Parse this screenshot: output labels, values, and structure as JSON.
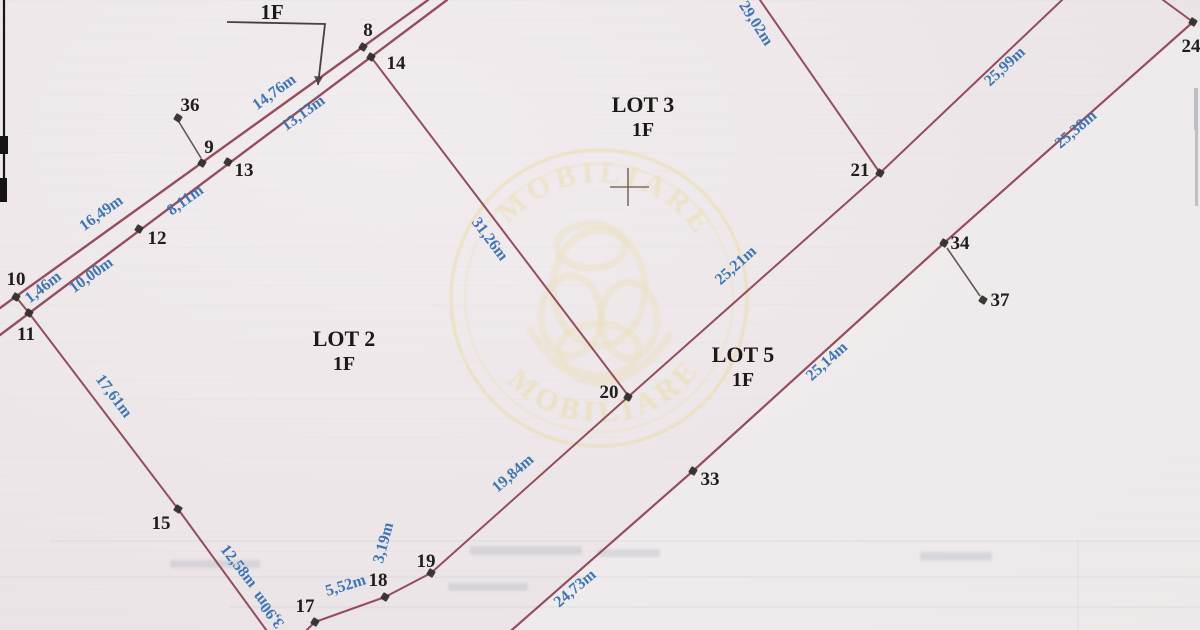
{
  "document": {
    "kind": "scanned cadastral lot plan",
    "floor_note": {
      "label": "1F",
      "x": 272,
      "y": 19,
      "bracket": [
        [
          227,
          22
        ],
        [
          325,
          24
        ],
        [
          318,
          85
        ]
      ]
    },
    "lot_labels": [
      {
        "name": "LOT 3",
        "floor": "1F",
        "x": 643,
        "y": 112
      },
      {
        "name": "LOT 2",
        "floor": "1F",
        "x": 344,
        "y": 346
      },
      {
        "name": "LOT 5",
        "floor": "1F",
        "x": 743,
        "y": 362
      }
    ],
    "cross_marker": {
      "x": 628,
      "y": 187
    },
    "boundary_lines": [
      {
        "x1": 0,
        "y1": 308,
        "x2": 428,
        "y2": 0,
        "w": 2.4
      },
      {
        "x1": 0,
        "y1": 335,
        "x2": 447,
        "y2": 0,
        "w": 2.4
      },
      {
        "x1": 16,
        "y1": 297,
        "x2": 29,
        "y2": 313,
        "w": 2
      },
      {
        "x1": 371,
        "y1": 57,
        "x2": 630,
        "y2": 398,
        "w": 2
      },
      {
        "x1": 29,
        "y1": 313,
        "x2": 178,
        "y2": 509,
        "w": 2
      },
      {
        "x1": 178,
        "y1": 509,
        "x2": 283,
        "y2": 653,
        "w": 2
      },
      {
        "x1": 283,
        "y1": 653,
        "x2": 315,
        "y2": 622,
        "w": 2
      },
      {
        "x1": 315,
        "y1": 622,
        "x2": 385,
        "y2": 597,
        "w": 2
      },
      {
        "x1": 385,
        "y1": 597,
        "x2": 431,
        "y2": 573,
        "w": 2
      },
      {
        "x1": 431,
        "y1": 573,
        "x2": 628,
        "y2": 397,
        "w": 2
      },
      {
        "x1": 628,
        "y1": 397,
        "x2": 880,
        "y2": 173,
        "w": 2
      },
      {
        "x1": 880,
        "y1": 173,
        "x2": 760,
        "y2": 0,
        "w": 2
      },
      {
        "x1": 880,
        "y1": 173,
        "x2": 1062,
        "y2": 0,
        "w": 2
      },
      {
        "x1": 1163,
        "y1": 0,
        "x2": 1193,
        "y2": 22,
        "w": 2
      },
      {
        "x1": 1193,
        "y1": 22,
        "x2": 944,
        "y2": 243,
        "w": 2.2
      },
      {
        "x1": 944,
        "y1": 243,
        "x2": 693,
        "y2": 471,
        "w": 2.2
      },
      {
        "x1": 693,
        "y1": 471,
        "x2": 505,
        "y2": 636,
        "w": 2.2
      }
    ],
    "leader_lines": [
      {
        "x1": 179,
        "y1": 122,
        "x2": 201,
        "y2": 158
      },
      {
        "x1": 947,
        "y1": 248,
        "x2": 980,
        "y2": 296
      }
    ],
    "points": [
      {
        "id": "8",
        "px": 363,
        "py": 47,
        "lx": 368,
        "ly": 30
      },
      {
        "id": "9",
        "px": 202,
        "py": 163,
        "lx": 209,
        "ly": 147
      },
      {
        "id": "10",
        "px": 16,
        "py": 297,
        "lx": 16,
        "ly": 279
      },
      {
        "id": "11",
        "px": 29,
        "py": 313,
        "lx": 26,
        "ly": 334
      },
      {
        "id": "12",
        "px": 139,
        "py": 229,
        "lx": 157,
        "ly": 238
      },
      {
        "id": "13",
        "px": 228,
        "py": 162,
        "lx": 244,
        "ly": 170
      },
      {
        "id": "14",
        "px": 371,
        "py": 57,
        "lx": 396,
        "ly": 63
      },
      {
        "id": "15",
        "px": 178,
        "py": 509,
        "lx": 161,
        "ly": 523
      },
      {
        "id": "17",
        "px": 315,
        "py": 622,
        "lx": 305,
        "ly": 606
      },
      {
        "id": "18",
        "px": 385,
        "py": 597,
        "lx": 378,
        "ly": 580
      },
      {
        "id": "19",
        "px": 431,
        "py": 573,
        "lx": 426,
        "ly": 561
      },
      {
        "id": "20",
        "px": 628,
        "py": 397,
        "lx": 609,
        "ly": 392
      },
      {
        "id": "21",
        "px": 880,
        "py": 173,
        "lx": 860,
        "ly": 170
      },
      {
        "id": "24",
        "px": 1193,
        "py": 22,
        "lx": 1191,
        "ly": 46
      },
      {
        "id": "33",
        "px": 693,
        "py": 471,
        "lx": 710,
        "ly": 479
      },
      {
        "id": "34",
        "px": 944,
        "py": 243,
        "lx": 960,
        "ly": 243
      },
      {
        "id": "36",
        "px": 178,
        "py": 118,
        "lx": 190,
        "ly": 105
      },
      {
        "id": "37",
        "px": 983,
        "py": 300,
        "lx": 1000,
        "ly": 300
      }
    ],
    "distance_labels": [
      {
        "text": "14,76m",
        "x": 277,
        "y": 96,
        "rot": -36
      },
      {
        "text": "13,13m",
        "x": 306,
        "y": 117,
        "rot": -36
      },
      {
        "text": "16,49m",
        "x": 104,
        "y": 217,
        "rot": -36
      },
      {
        "text": "8,11m",
        "x": 188,
        "y": 204,
        "rot": -36
      },
      {
        "text": "10,00m",
        "x": 94,
        "y": 279,
        "rot": -36
      },
      {
        "text": "1,46m",
        "x": 46,
        "y": 291,
        "rot": -38
      },
      {
        "text": "17,61m",
        "x": 110,
        "y": 399,
        "rot": 53
      },
      {
        "text": "12,58m",
        "x": 235,
        "y": 569,
        "rot": 52
      },
      {
        "text": "3,90m",
        "x": 272,
        "y": 607,
        "rot": -128
      },
      {
        "text": "5,52m",
        "x": 347,
        "y": 590,
        "rot": -17
      },
      {
        "text": "3,19m",
        "x": 388,
        "y": 544,
        "rot": -75
      },
      {
        "text": "19,84m",
        "x": 516,
        "y": 477,
        "rot": -41
      },
      {
        "text": "31,26m",
        "x": 486,
        "y": 242,
        "rot": 53
      },
      {
        "text": "29,02m",
        "x": 752,
        "y": 26,
        "rot": 57
      },
      {
        "text": "25,99m",
        "x": 1008,
        "y": 70,
        "rot": -43
      },
      {
        "text": "25,38m",
        "x": 1079,
        "y": 133,
        "rot": -41
      },
      {
        "text": "25,21m",
        "x": 739,
        "y": 269,
        "rot": -42
      },
      {
        "text": "25,14m",
        "x": 830,
        "y": 365,
        "rot": -42
      },
      {
        "text": "24,73m",
        "x": 578,
        "y": 592,
        "rot": -40
      }
    ],
    "watermark": {
      "cx": 599,
      "cy": 298,
      "outer_r": 148,
      "text_r_top": 116,
      "text_r_bottom": 124,
      "arc_top": "IMOBILIARE",
      "arc_bottom": "IMOBILIARE"
    },
    "colors": {
      "boundary": "#8d4154",
      "leader": "#46413d",
      "marker": "#33302c",
      "point_text": "#201d1b",
      "distance_text": "#3570b0",
      "lot_text": "#1c1917",
      "cross": "#6f6058",
      "watermark": "#e9db9f",
      "bleed": "#9fa6b4",
      "edge_black": "#141414",
      "edge_gray": "#8e939b"
    },
    "artifacts": {
      "right_light_polygon": "1200,28 1193,22 944,243 693,471 505,636 1200,636",
      "left_edge_line": {
        "x": 4,
        "y1": 0,
        "y2": 200,
        "w": 2.2
      },
      "left_edge_blobs": [
        [
          0,
          136,
          8,
          18
        ],
        [
          0,
          178,
          7,
          24
        ]
      ],
      "right_edge_streaks": [
        [
          1194,
          88,
          4,
          42
        ],
        [
          1195,
          130,
          3,
          76
        ]
      ],
      "bleed_lines": [
        [
          50,
          541,
          1200,
          541
        ],
        [
          0,
          577,
          1200,
          577
        ],
        [
          230,
          607,
          1200,
          607
        ],
        [
          1078,
          540,
          1078,
          630
        ]
      ],
      "bleed_smudges": [
        [
          470,
          546,
          112,
          9
        ],
        [
          448,
          583,
          80,
          8
        ],
        [
          920,
          552,
          72,
          9
        ],
        [
          598,
          549,
          62,
          8
        ],
        [
          170,
          560,
          90,
          8
        ]
      ]
    }
  }
}
